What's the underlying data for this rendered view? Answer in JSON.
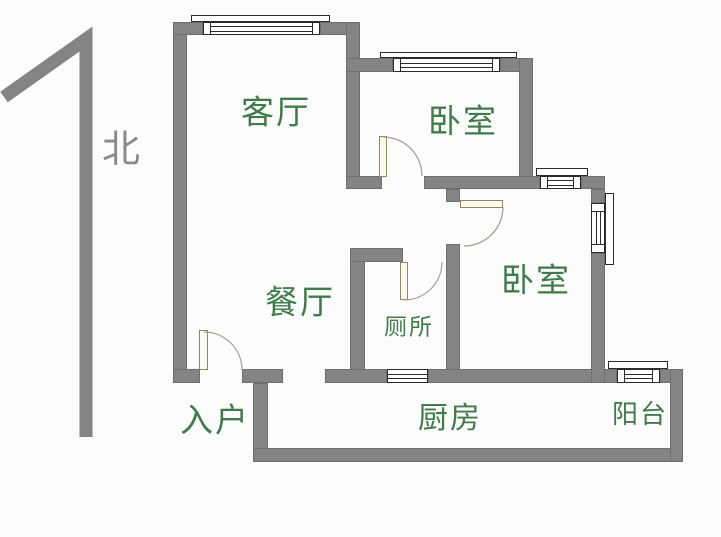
{
  "plan": {
    "type": "apartment-floor-plan",
    "north": {
      "label": "北"
    },
    "rooms": {
      "living": {
        "label": "客厅"
      },
      "bedroom_top": {
        "label": "卧室"
      },
      "bedroom_right": {
        "label": "卧室"
      },
      "dining": {
        "label": "餐厅"
      },
      "toilet": {
        "label": "厕所"
      },
      "entry": {
        "label": "入户"
      },
      "kitchen": {
        "label": "厨房"
      },
      "balcony": {
        "label": "阳台"
      }
    }
  },
  "colors": {
    "background": "#fcfcfc",
    "wall": "#848484",
    "wall_edge": "#6f6f6f",
    "window_line": "#2b2b2b",
    "door_fill": "#fcfaec",
    "door_edge": "#8f895f",
    "arc": "#a29c88",
    "label_green": "#3e7c4a",
    "north_gray": "#8a8a8a"
  }
}
